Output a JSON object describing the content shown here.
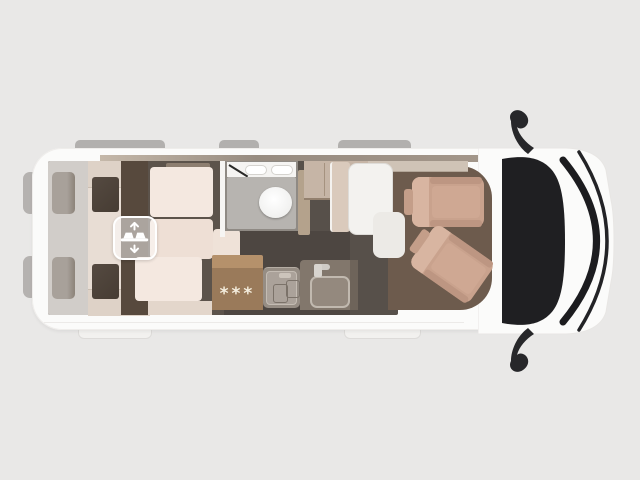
{
  "image": {
    "description": "Top-down cutaway floor plan of a camper van, cab at right",
    "background_color": "#e9e8e7"
  },
  "van": {
    "body_color": "#fbfbfa",
    "floor_color": "#57504a",
    "cab_floor_color": "#6d5b4d",
    "windshield_color": "#1f1f22",
    "mattress_color": "#f4e8e0",
    "lounge_color": "#e8ddd4",
    "seat_color": "#c9a28d",
    "kitchen_cabinet_color": "#9a7a5a",
    "shower_floor_color": "#b7b4b0",
    "table_color": "#f3f2ef"
  },
  "fridge": {
    "stars": "***"
  },
  "icons": {
    "conversion_badge": "seats-convert-to-bed-icon",
    "badge_arrow_up": "arrow-up",
    "badge_arrow_down": "arrow-down",
    "mirrors": "side-mirror-icon",
    "toilet": "toilet-bowl",
    "burners": "stove-burners",
    "sink": "kitchen-sink"
  }
}
